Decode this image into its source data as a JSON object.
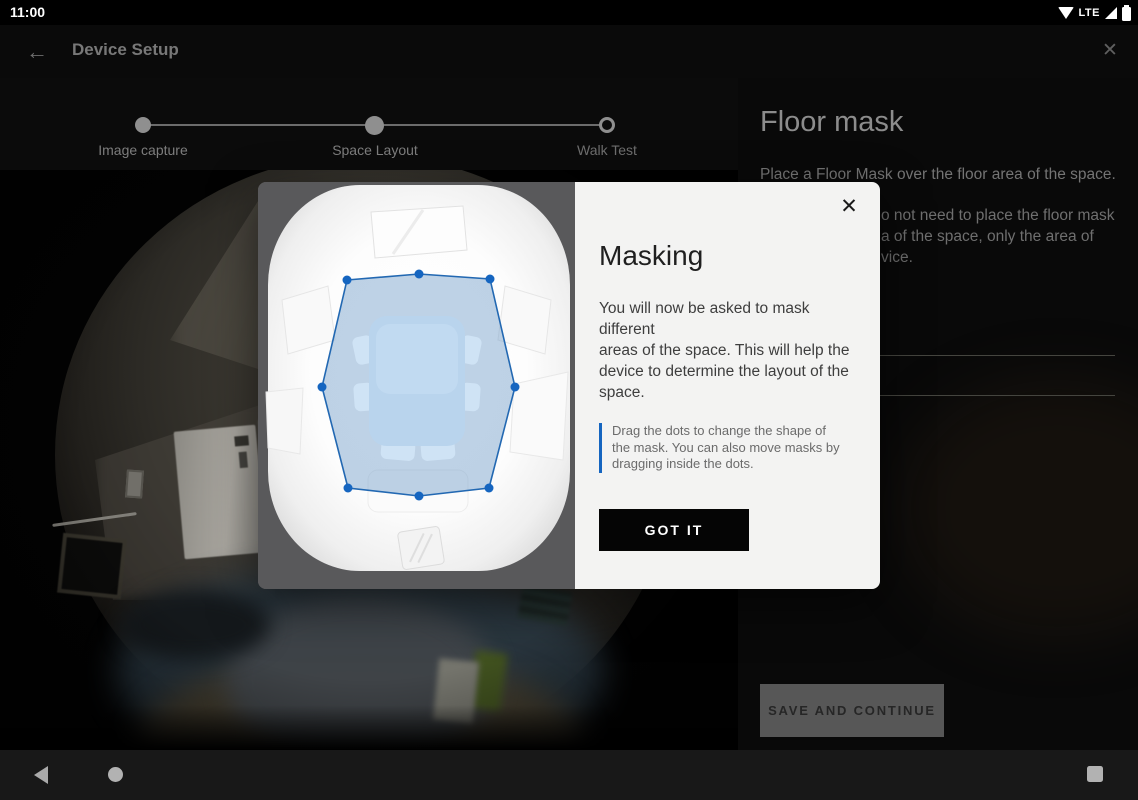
{
  "status_bar": {
    "time": "11:00",
    "network_label": "LTE"
  },
  "app_bar": {
    "title": "Device Setup",
    "back_icon": "←",
    "close_icon": "✕"
  },
  "stepper": {
    "steps": [
      {
        "label": "Image capture",
        "state": "complete"
      },
      {
        "label": "Space Layout",
        "state": "active"
      },
      {
        "label": "Walk Test",
        "state": "pending"
      }
    ]
  },
  "side_panel": {
    "title": "Floor mask",
    "intro": "Place a Floor Mask over the floor area of the space.",
    "obscured_lines": [
      "o not need to place the floor mask",
      "a of the space, only the area of",
      "vice."
    ],
    "save_button_label": "SAVE AND CONTINUE"
  },
  "dialog": {
    "title": "Masking",
    "close_icon": "✕",
    "body": "You will now be asked to mask different\nareas of the space. This will help the\ndevice to determine the layout of the\nspace.",
    "tip": "Drag the dots to change the shape of\nthe mask. You can also move masks by\ndragging inside the dots.",
    "confirm_label": "GOT IT",
    "accent_color": "#1565c0",
    "mask": {
      "fill": "#7ea6cd",
      "fill_opacity": 0.5,
      "stroke": "#2268b2",
      "dot_color": "#1565c0",
      "dot_radius": 4.5,
      "points": [
        [
          89,
          98
        ],
        [
          161,
          92
        ],
        [
          232,
          97
        ],
        [
          257,
          205
        ],
        [
          231,
          306
        ],
        [
          161,
          314
        ],
        [
          90,
          306
        ],
        [
          64,
          205
        ]
      ]
    }
  },
  "nav_bar": {
    "icons": [
      "back-triangle",
      "home-circle",
      "recents-square"
    ]
  }
}
